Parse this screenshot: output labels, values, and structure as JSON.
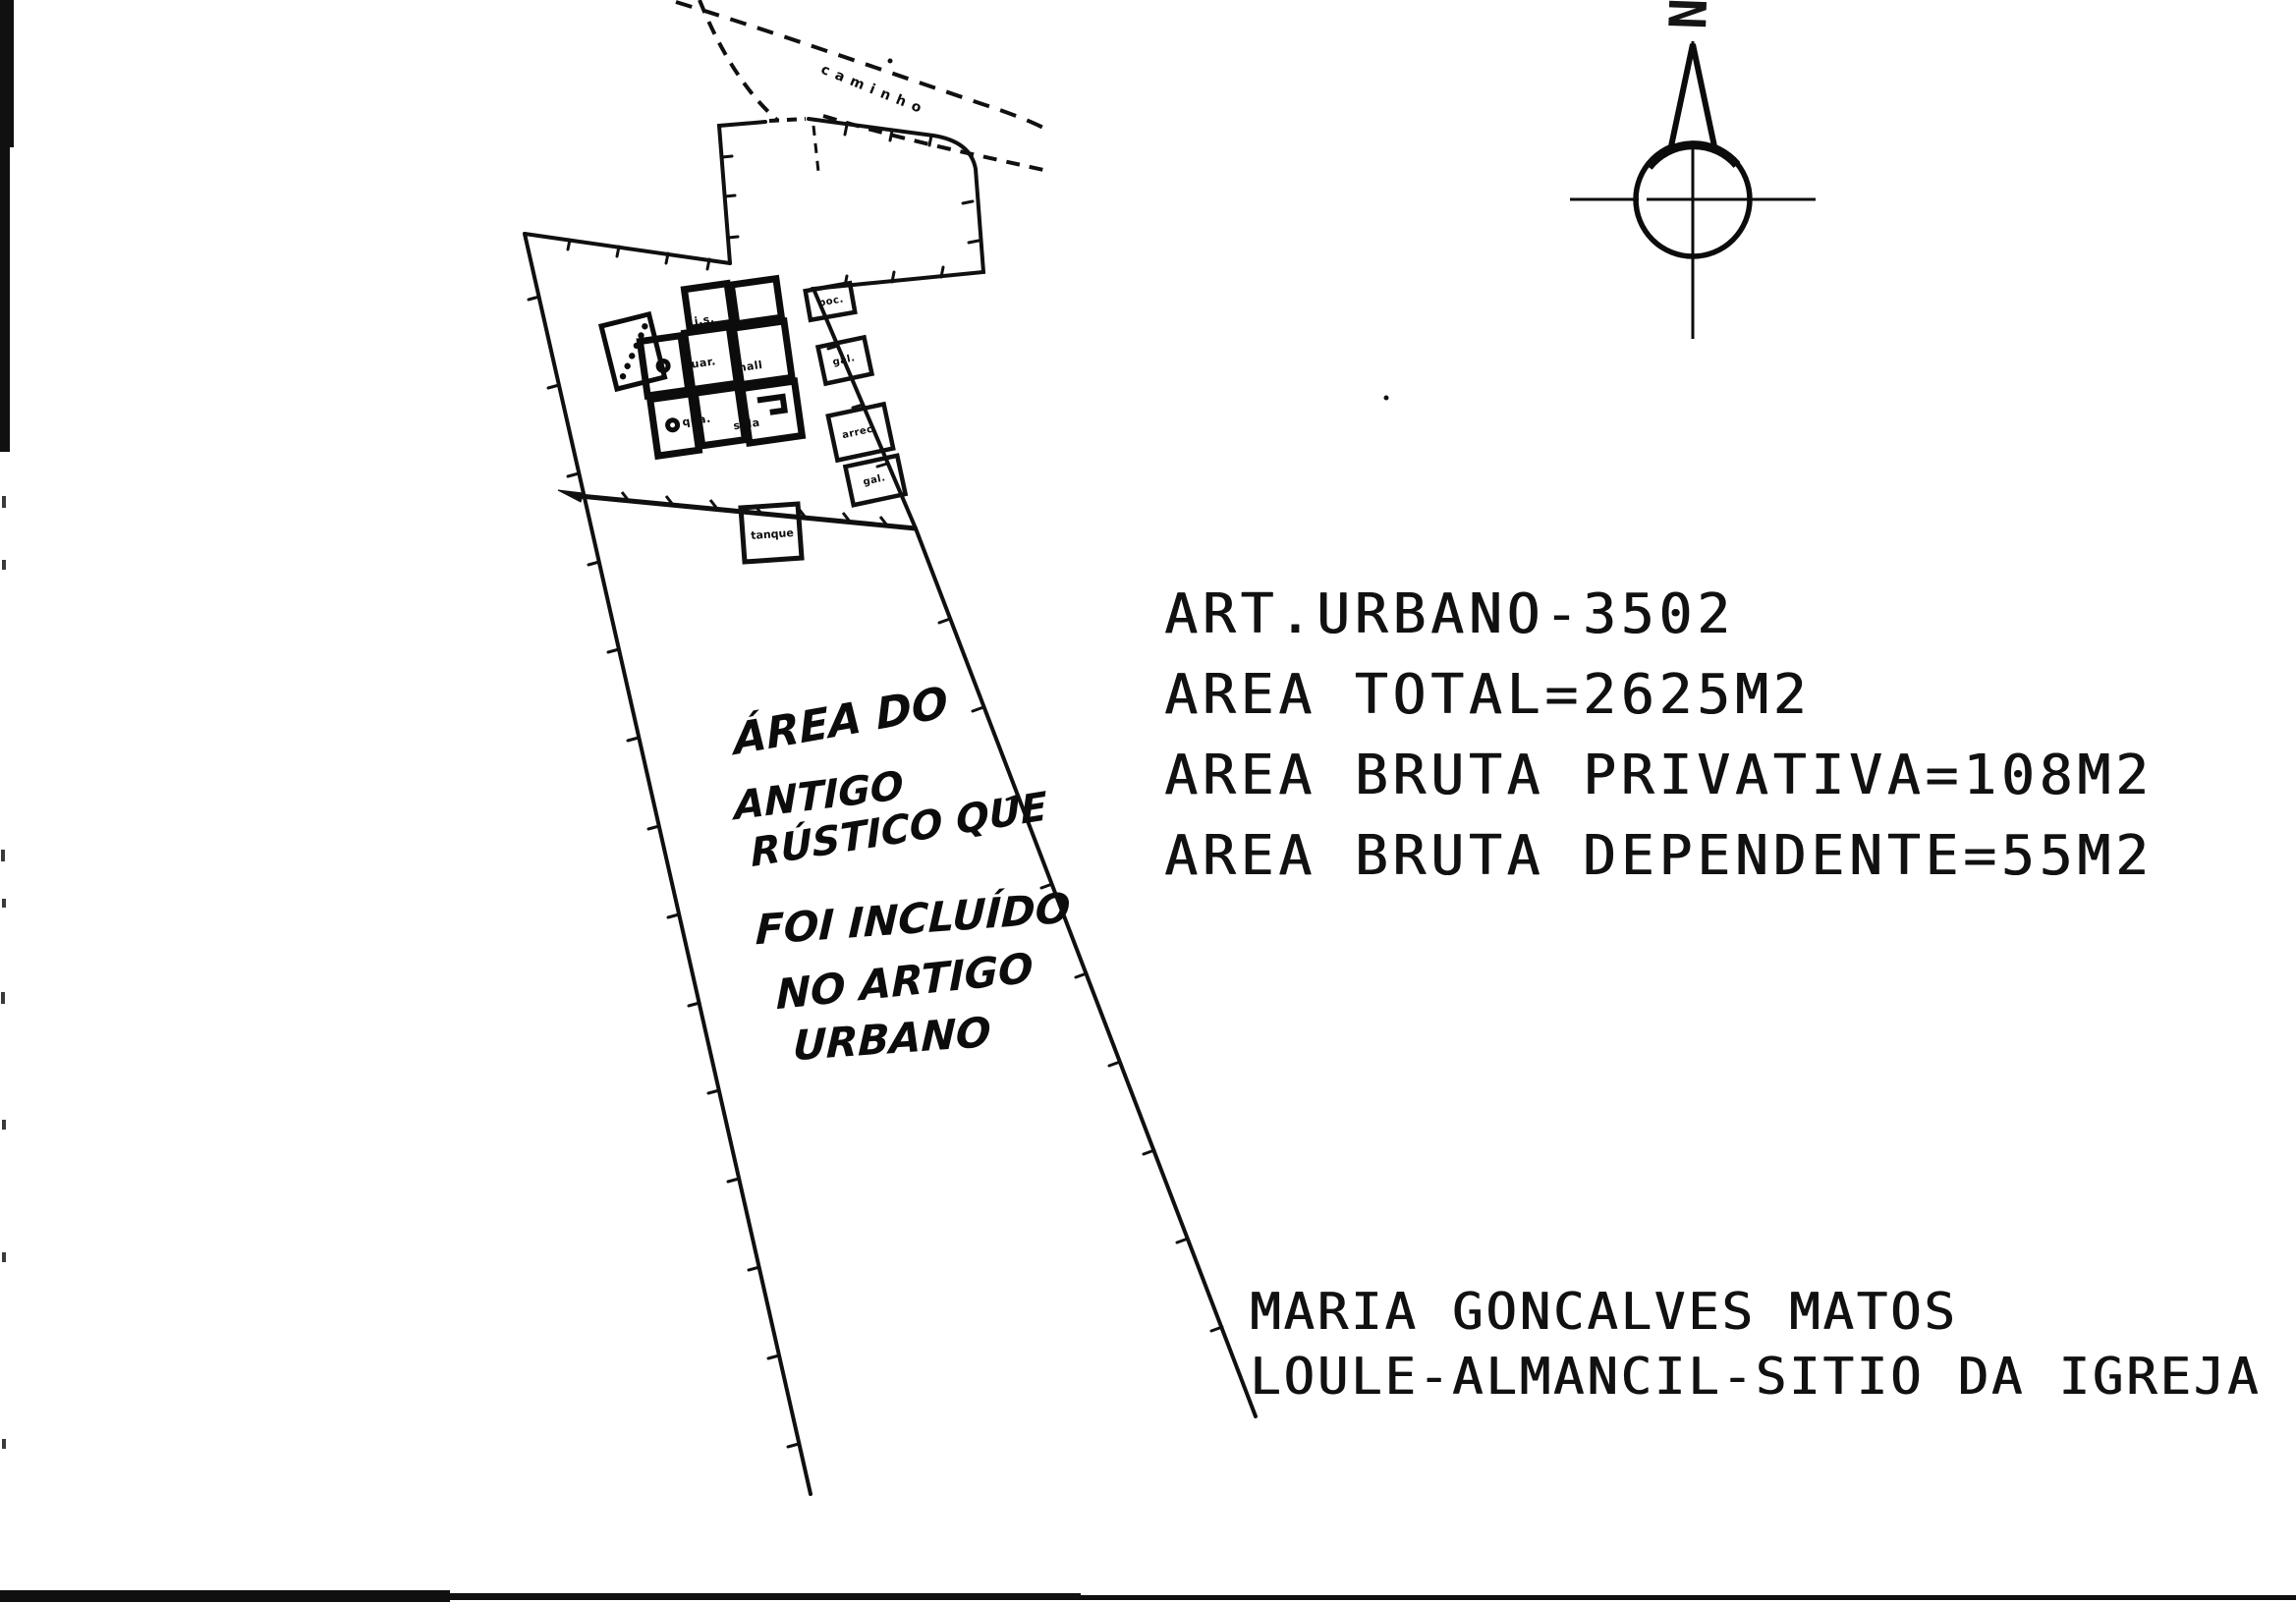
{
  "colors": {
    "paper": "#ffffff",
    "ink": "#151515"
  },
  "typed_block": {
    "lines": [
      "ART.URBANO-3502",
      "AREA TOTAL=2625M2",
      "AREA BRUTA PRIVATIVA=108M2",
      "AREA BRUTA DEPENDENTE=55M2"
    ]
  },
  "owner_block": {
    "lines": [
      "MARIA GONCALVES MATOS",
      "LOULE-ALMANCIL-SITIO DA IGREJA"
    ]
  },
  "handwriting": {
    "lines": [
      "ÁREA DO",
      "ANTIGO",
      "RÚSTICO QUE",
      "FOI INCLUÍDO",
      "NO ARTIGO",
      "URBANO"
    ]
  },
  "plan": {
    "path_label": "caminho",
    "north_label": "N",
    "tank_label": "tanque",
    "room_labels": [
      "i.s.",
      "coz.",
      "quar.",
      "hall",
      "qua.",
      "sala"
    ],
    "outbuilding_labels": [
      "poc.",
      "gal.",
      "arrec.",
      "gal."
    ]
  }
}
